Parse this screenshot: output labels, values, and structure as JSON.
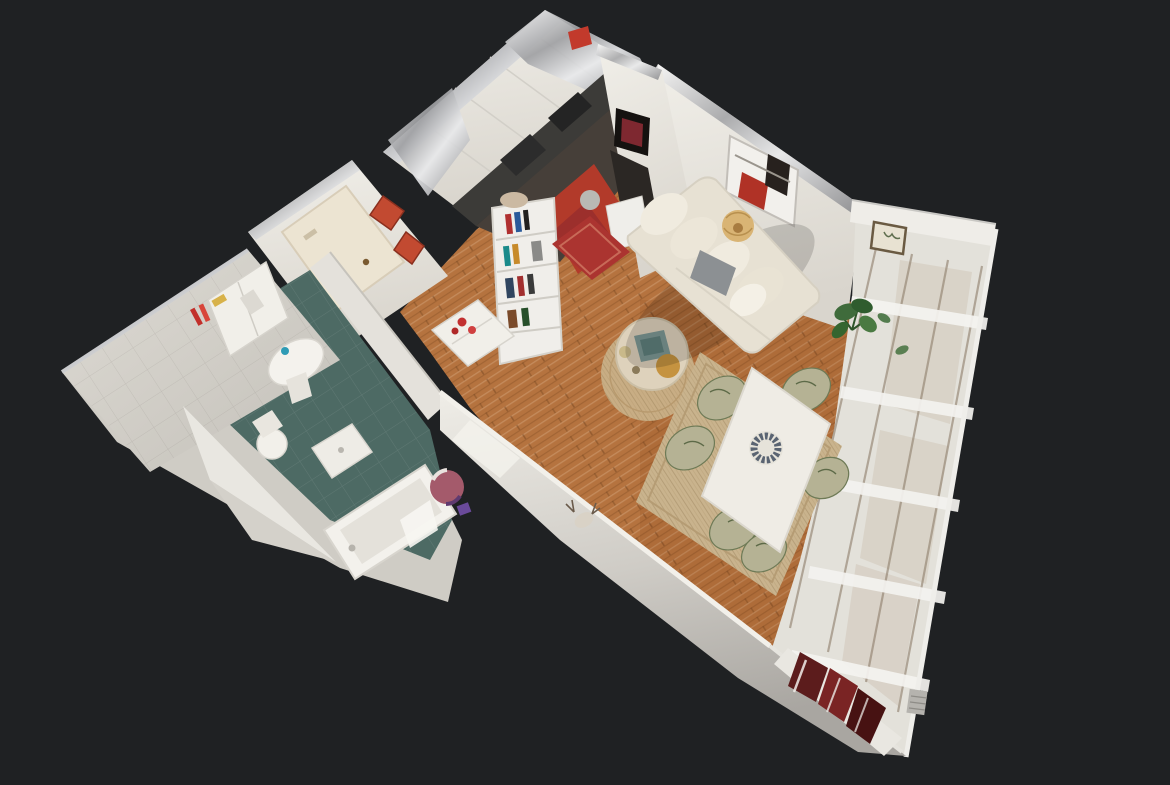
{
  "scene": {
    "description": "3D dollhouse cutaway view of a small apartment floating on a dark backdrop",
    "colors": {
      "backdrop": "#1f2123",
      "wall": "#eae7e1",
      "wall_shade": "#c9c6c0",
      "bathroom_tile_wall": "#d8d5ce",
      "bathroom_floor": "#4d6a64",
      "wood_floor": "#b5733f",
      "kitchen_floor_red": "#b23a2a",
      "entry_rug_red": "#ab3430",
      "door_cream": "#ece4d2",
      "diamond_art_red": "#c24a31",
      "sofa_cream": "#e7e1d3",
      "pillow_gray": "#8c9093",
      "rug_jute": "#c9b38d",
      "round_rug_jute": "#c8ad84",
      "dining_table_white": "#efece5",
      "chair_leaf": "#b5b294",
      "plant_green": "#3f6b3b",
      "window_glass": "#e3e1da",
      "window_frame_brown": "#8d7d6a",
      "maroon_books": "#5c1c1c",
      "countertop_dark": "#3c3b38",
      "cut_metal_edge": "#b9b9ba",
      "coffee_table_stone": "#ded2bc",
      "tray_teal": "#7d9894",
      "gold_decor": "#c59340"
    },
    "objects": {
      "rooms": [
        "kitchen",
        "entry",
        "hallway",
        "bathroom",
        "living-room",
        "dining-area"
      ],
      "furniture": [
        "sofa",
        "dining-table",
        "dining-chairs",
        "coffee-table",
        "bookshelf",
        "side-cabinet",
        "bathtub",
        "toilet",
        "pedestal-sink",
        "washbasin",
        "laundry-basket",
        "corner-bookshelf"
      ],
      "decor": [
        "abstract-wall-art",
        "dark-framed-art",
        "diamond-wall-art",
        "botanical-framed-art",
        "pendant-lamp",
        "monstera-plant",
        "centerpiece-wreath",
        "entry-red-rug",
        "kitchen-red-rug",
        "round-jute-rug",
        "dining-jute-rug",
        "deer-sketch-art"
      ]
    }
  }
}
